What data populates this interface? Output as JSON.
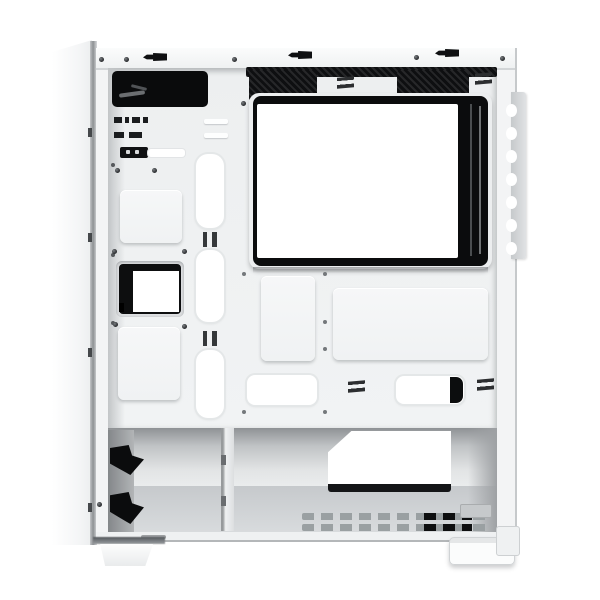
{
  "scene": {
    "type": "product-photo",
    "subject": "White mid-tower PC case shown from the open side with the panel removed, exposing the interior frame",
    "background_color": "#ffffff"
  },
  "colors": {
    "case_white": "#f4f5f6",
    "tray_white": "#eef0f1",
    "cutout_white": "#ffffff",
    "frame_black": "#0c0d0e",
    "mesh_black": "#17181a",
    "shadow_gray": "#c9ccce",
    "floor_gray": "#d2d5d7",
    "bracket_gray": "#cfd2d4"
  },
  "parts": {
    "front_panel": {
      "label": "front panel slab"
    },
    "top_rail": {
      "label": "top frame rail with screws and latch clips",
      "screws": 5,
      "latch_clips": 3
    },
    "front_io_cutout": {
      "label": "front I/O cable cutout"
    },
    "top_fan_vents": {
      "label": "top fan vent mesh openings",
      "count": 2
    },
    "tray_window": {
      "label": "motherboard tray window with black frame"
    },
    "rear_bracket": {
      "label": "rear scalloped bracket strip",
      "notches": 7
    },
    "io_headers": {
      "label": "front panel connector headers"
    },
    "switch_slot": {
      "label": "slide latch beside white slot"
    },
    "ssd_plates": {
      "label": "raised SSD mounting plates",
      "count": 2
    },
    "drive_bay_cutout": {
      "label": "front drive bay cutout"
    },
    "cable_grommets": {
      "label": "vertical cable routing grommets",
      "count": 3
    },
    "mount_panels": {
      "label": "raised mounting panels on tray",
      "count": 2
    },
    "routing_slots": {
      "label": "cable routing slots above basement",
      "count": 2
    },
    "basement": {
      "label": "open PSU basement compartment"
    },
    "drive_cage": {
      "label": "drive cage with rubber clips",
      "clips": 2
    },
    "divider": {
      "label": "basement divider wall"
    },
    "psu_opening": {
      "label": "PSU mounting opening in rear wall"
    },
    "floor_vents": {
      "label": "bottom ventilation slot grid"
    },
    "feet": {
      "label": "case feet",
      "count": 2
    }
  }
}
